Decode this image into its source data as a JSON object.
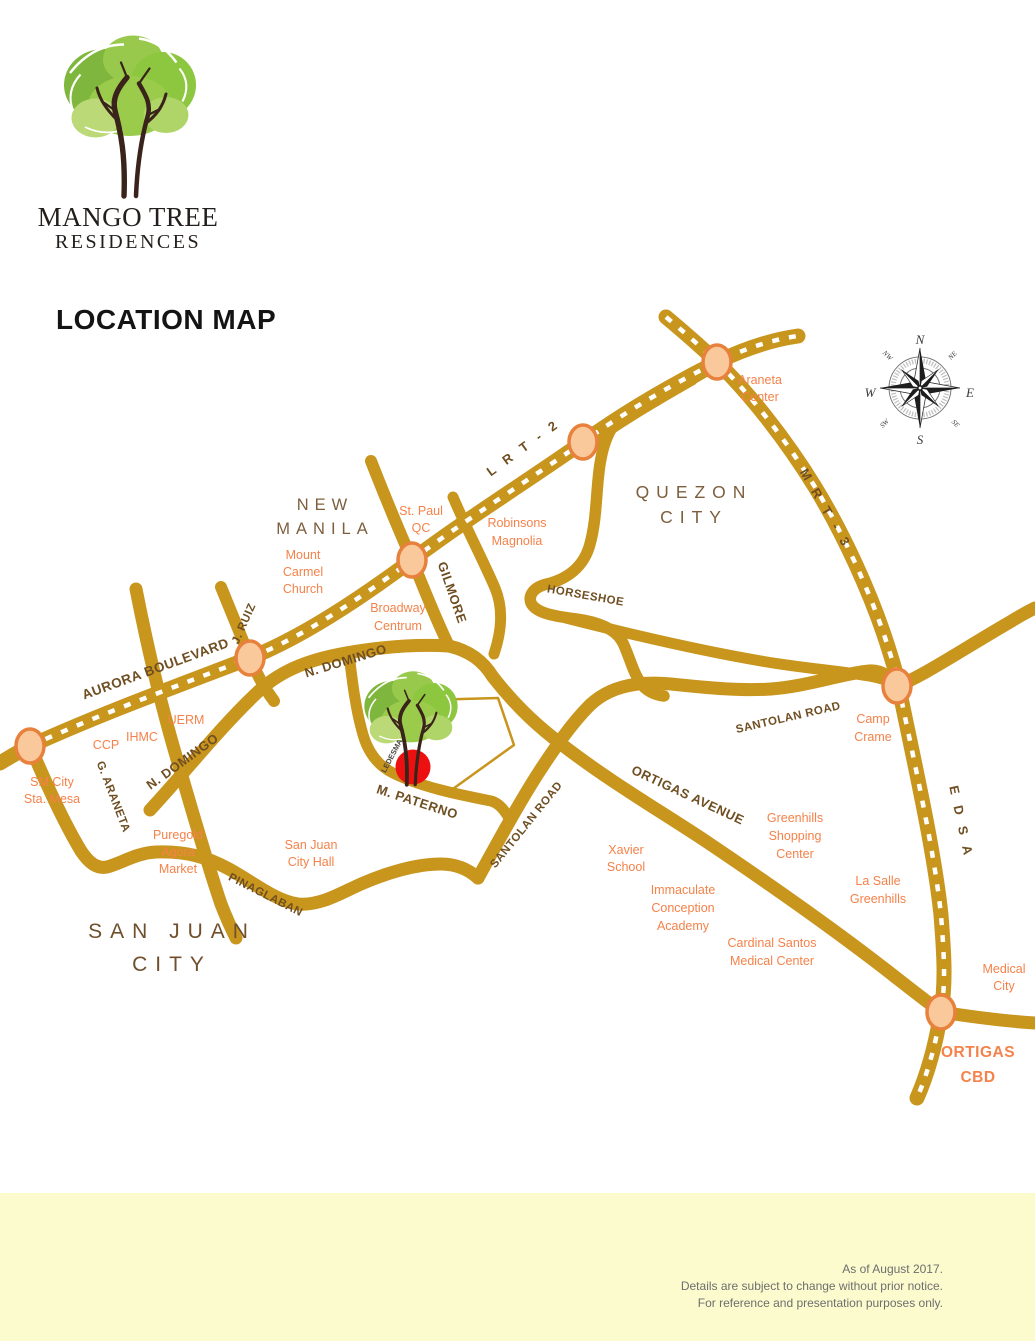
{
  "logo": {
    "brand_line1": "MANGO TREE",
    "brand_line2": "RESIDENCES"
  },
  "page_title": "LOCATION MAP",
  "compass": {
    "n": "N",
    "e": "E",
    "s": "S",
    "w": "W",
    "ne": "NE",
    "se": "SE",
    "sw": "SW",
    "nw": "NW"
  },
  "areas": {
    "new_manila": [
      "NEW",
      "MANILA"
    ],
    "quezon_city": [
      "QUEZON",
      "CITY"
    ],
    "san_juan_city": [
      "SAN JUAN",
      "CITY"
    ]
  },
  "roads": {
    "aurora": "AURORA BOULEVARD",
    "jruiz": "J. RUIZ",
    "gilmore": "GILMORE",
    "ndomingo": "N. DOMINGO",
    "horseshoe": "HORSESHOE",
    "santolan": "SANTOLAN ROAD",
    "ortigas": "ORTIGAS AVENUE",
    "mpaterno": "M. PATERNO",
    "pinaglaban": "PINAGLABAN",
    "garaneta": "G. ARANETA",
    "ledesma": "LEDESMA"
  },
  "transit": {
    "lrt2": "L R T - 2",
    "mrt3": "M R T - 3",
    "edsa": "E D S A"
  },
  "landmarks": {
    "araneta_center": [
      "Araneta",
      "Center"
    ],
    "st_paul": [
      "St. Paul",
      "QC"
    ],
    "robinsons": [
      "Robinsons",
      "Magnolia"
    ],
    "mt_carmel": [
      "Mount",
      "Carmel",
      "Church"
    ],
    "broadway": [
      "Broadway",
      "Centrum"
    ],
    "uerm": "UERM",
    "ihmc": "IHMC",
    "ccp": "CCP",
    "sm_sta_mesa": [
      "SM City",
      "Sta. Mesa"
    ],
    "puregold": [
      "Puregold",
      "Agora",
      "Market"
    ],
    "city_hall": [
      "San Juan",
      "City Hall"
    ],
    "xavier": [
      "Xavier",
      "School"
    ],
    "ica": [
      "Immaculate",
      "Conception",
      "Academy"
    ],
    "greenhills": [
      "Greenhills",
      "Shopping",
      "Center"
    ],
    "lasalle": [
      "La Salle",
      "Greenhills"
    ],
    "cardinal": [
      "Cardinal Santos",
      "Medical Center"
    ],
    "camp_crame": [
      "Camp",
      "Crame"
    ],
    "medical_city": [
      "Medical",
      "City"
    ],
    "ortigas_cbd": [
      "ORTIGAS",
      "CBD"
    ]
  },
  "footer": {
    "line1": "As of August 2017.",
    "line2": "Details are subject to change without prior notice.",
    "line3": "For reference and presentation purposes only."
  },
  "colors": {
    "road": "#C8951D",
    "rail_dash": "#FFFFFF",
    "station_fill": "#F9C89B",
    "station_stroke": "#E7813B",
    "landmark_text": "#F5824A",
    "road_label": "#6F4E22",
    "area_label": "#7D5F3E",
    "site_marker": "#ED1010",
    "footer_bg": "#FCFBCE",
    "footer_text": "#6E6E6E"
  }
}
